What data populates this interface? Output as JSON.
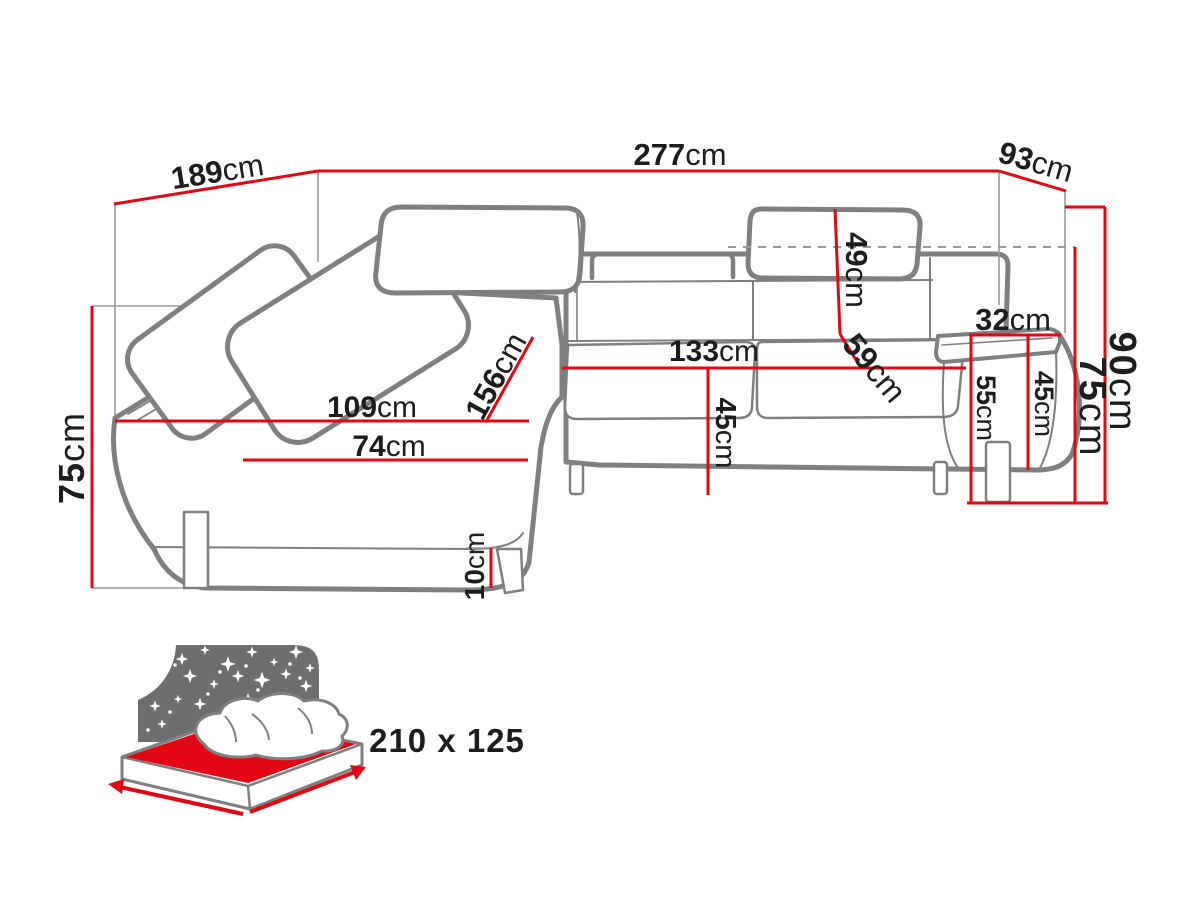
{
  "unit": "cm",
  "dimensions": {
    "d189": "189",
    "d277": "277",
    "d93": "93",
    "d90": "90",
    "d75_right": "75",
    "d75_left": "75",
    "d49": "49",
    "d59": "59",
    "d32": "32",
    "d55": "55",
    "d45_right": "45",
    "d133": "133",
    "d45_middle": "45",
    "d109": "109",
    "d74": "74",
    "d156": "156",
    "d10": "10"
  },
  "sleeping_area": {
    "label": "210 x 125"
  },
  "colors": {
    "dimension_red": "#e30613",
    "outline_gray": "#7f7f7f",
    "seam_gray": "#9a9a9a",
    "text_dark": "#1d1d1b",
    "muted_text_gray": "#6d6d6d",
    "bed_panel_gray": "#6e6e6e"
  }
}
